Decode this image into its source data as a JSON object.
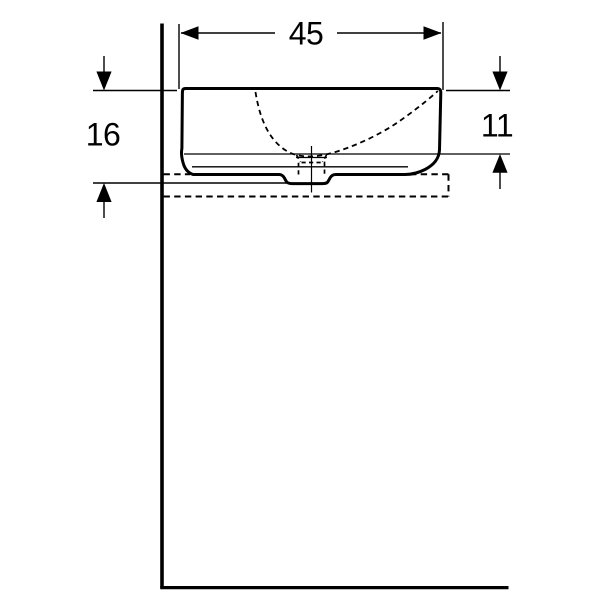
{
  "drawing": {
    "background_color": "#ffffff",
    "line_color": "#000000",
    "labels": {
      "width": "45",
      "total_height": "16",
      "rim_to_counter_height": "11"
    }
  }
}
